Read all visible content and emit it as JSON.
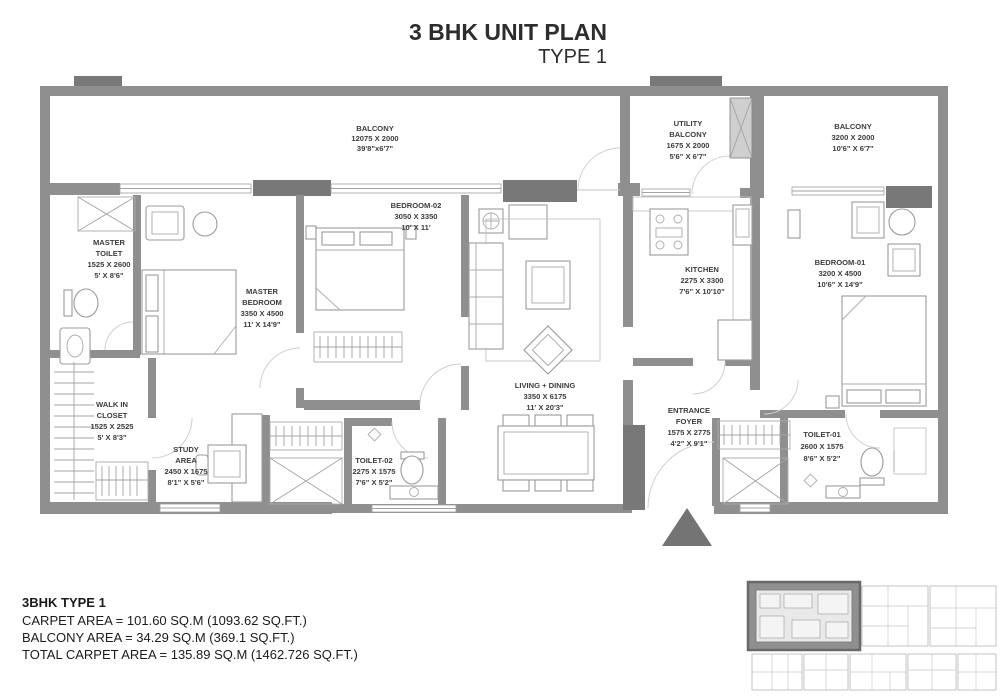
{
  "title": {
    "main": "3 BHK UNIT PLAN",
    "sub": "TYPE 1"
  },
  "rooms": [
    {
      "id": "balcony-main",
      "lines": [
        "BALCONY",
        "12075 X 2000",
        "39'8\"x6'7\""
      ]
    },
    {
      "id": "utility-balcony",
      "lines": [
        "UTILITY",
        "BALCONY",
        "1675 X 2000",
        "5'6\" X 6'7\""
      ]
    },
    {
      "id": "balcony-right",
      "lines": [
        "BALCONY",
        "3200 X 2000",
        "10'6\" X 6'7\""
      ]
    },
    {
      "id": "master-toilet",
      "lines": [
        "MASTER",
        "TOILET",
        "1525 X 2600",
        "5' X 8'6\""
      ]
    },
    {
      "id": "master-bedroom",
      "lines": [
        "MASTER",
        "BEDROOM",
        "3350 X 4500",
        "11' X 14'9\""
      ]
    },
    {
      "id": "bedroom-02",
      "lines": [
        "BEDROOM-02",
        "3050 X 3350",
        "10' X 11'"
      ]
    },
    {
      "id": "kitchen",
      "lines": [
        "KITCHEN",
        "2275 X 3300",
        "7'6\" X 10'10\""
      ]
    },
    {
      "id": "bedroom-01",
      "lines": [
        "BEDROOM-01",
        "3200 X 4500",
        "10'6\" X 14'9\""
      ]
    },
    {
      "id": "living-dining",
      "lines": [
        "LIVING + DINING",
        "3350 X 6175",
        "11' X 20'3\""
      ]
    },
    {
      "id": "walk-in-closet",
      "lines": [
        "WALK IN",
        "CLOSET",
        "1525 X 2525",
        "5' X 8'3\""
      ]
    },
    {
      "id": "study-area",
      "lines": [
        "STUDY",
        "AREA",
        "2450 X 1675",
        "8'1\" X 5'6\""
      ]
    },
    {
      "id": "toilet-02",
      "lines": [
        "TOILET-02",
        "2275 X 1575",
        "7'6\" X 5'2\""
      ]
    },
    {
      "id": "entrance-foyer",
      "lines": [
        "ENTRANCE",
        "FOYER",
        "1575 X 2775",
        "4'2\" X 9'1\""
      ]
    },
    {
      "id": "toilet-01",
      "lines": [
        "TOILET-01",
        "2600 X 1575",
        "8'6\" X 5'2\""
      ]
    }
  ],
  "summary": {
    "heading": "3BHK TYPE 1",
    "line1": "CARPET AREA = 101.60 SQ.M (1093.62 SQ.FT.)",
    "line2": "BALCONY AREA = 34.29  SQ.M (369.1 SQ.FT.)",
    "line3": "TOTAL CARPET AREA = 135.89 SQ.M (1462.726 SQ.FT.)"
  },
  "colors": {
    "wall": "#8f8f8f",
    "wall_dark": "#787878",
    "label_text": "#3c3c3c",
    "keyplan_highlight": "#8f8f8f"
  }
}
